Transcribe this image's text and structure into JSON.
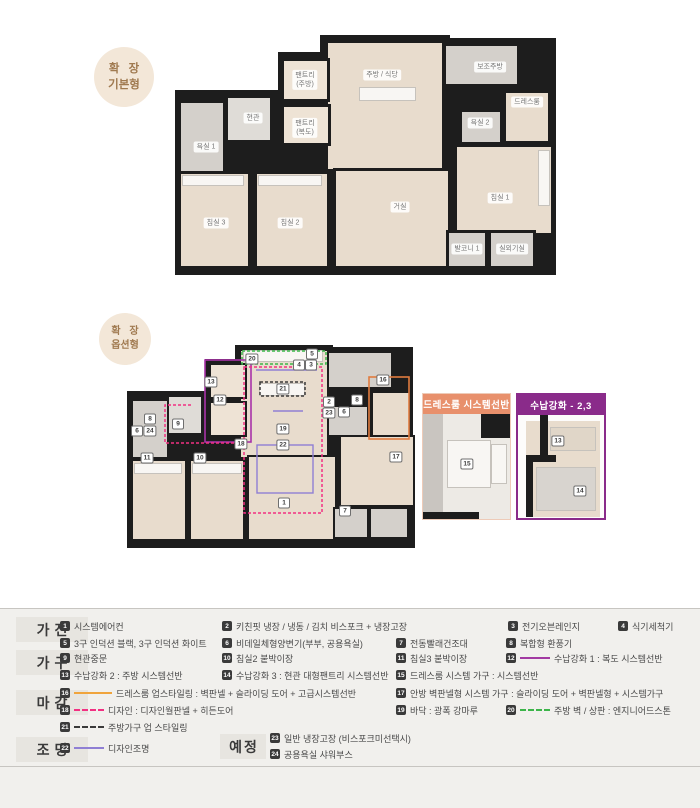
{
  "colors": {
    "badge_bg": "#f3e7d8",
    "badge_text": "#a07a50",
    "wall": "#1d1d1d",
    "floor_wood": "#e8dccd",
    "floor_tile": "#d4d0cb",
    "pink_dashed": "#f23082",
    "green_dashed": "#3cb54a",
    "dark_dashed": "#3a3a3a",
    "orange_outline": "#e07b3f",
    "orange_line": "#f0a43c",
    "purple_outline": "#a832a8",
    "violet_line": "#8f7fd4",
    "dressroom_box_header": "#e8906c",
    "storage_box_header": "#8a2b8a",
    "legend_bg": "#f1f0ed"
  },
  "plans": {
    "basic": {
      "badge": {
        "line1": "확 장",
        "line2": "기본형"
      },
      "rooms": [
        "욕실 1",
        "현관",
        "팬트리\n(주방)",
        "팬트리\n(복도)",
        "주방 / 식당",
        "보조주방",
        "욕실 2",
        "드레스룸",
        "침실 3",
        "침실 2",
        "거실",
        "침실 1",
        "발코니 1",
        "실외기실"
      ]
    },
    "option": {
      "badge": {
        "line1": "확 장",
        "line2": "옵션형"
      },
      "markers": {
        "n1": "1",
        "n2": "2",
        "n3": "3",
        "n4": "4",
        "n5": "5",
        "n6": "6",
        "n7": "7",
        "n8": "8",
        "n9": "9",
        "n10": "10",
        "n11": "11",
        "n12": "12",
        "n13": "13",
        "n16": "16",
        "n17": "17",
        "n18": "18",
        "n19": "19",
        "n20": "20",
        "n21": "21",
        "n22": "22",
        "n23": "23",
        "n24": "24"
      }
    }
  },
  "detail_boxes": [
    {
      "title": "드레스룸 시스템선반",
      "markers": [
        "15"
      ]
    },
    {
      "title": "수납강화 - 2,3",
      "markers": [
        "13",
        "14"
      ]
    }
  ],
  "legend": {
    "categories": [
      {
        "label": "가전",
        "items": [
          {
            "num": "1",
            "text": "시스템에어컨"
          },
          {
            "num": "2",
            "text": "키친핏 냉장 / 냉동 / 김치 비스포크 + 냉장고장"
          },
          {
            "num": "3",
            "text": "전기오븐레인지"
          },
          {
            "num": "4",
            "text": "식기세척기"
          },
          {
            "num": "5",
            "text": "3구 인덕션 블랙, 3구 인덕션 화이트"
          },
          {
            "num": "6",
            "text": "비데일체형양변기(부부, 공용욕실)"
          },
          {
            "num": "7",
            "text": "전동빨래건조대"
          },
          {
            "num": "8",
            "text": "복합형 환풍기"
          }
        ]
      },
      {
        "label": "가구",
        "items": [
          {
            "num": "9",
            "text": "현관중문"
          },
          {
            "num": "10",
            "text": "침실2 붙박이장"
          },
          {
            "num": "11",
            "text": "침실3 붙박이장"
          },
          {
            "num": "12",
            "text": "수납강화 1 : 복도 시스템선반"
          },
          {
            "num": "13",
            "text": "수납강화 2 : 주방 시스템선반"
          },
          {
            "num": "14",
            "text": "수납강화 3 : 현관 대형팬트리 시스템선반"
          },
          {
            "num": "15",
            "text": "드레스룸 시스템 가구 : 시스템선반"
          }
        ]
      },
      {
        "label": "마감",
        "items": [
          {
            "num": "16",
            "text": "드레스룸 업스타일링 : 벽판넬 + 슬라이딩 도어 + 고급시스템선반"
          },
          {
            "num": "17",
            "text": "안방 벽판넬형 시스템 가구 : 슬라이딩 도어 + 벽판넬형 + 시스템가구"
          },
          {
            "num": "18",
            "text": "디자인 : 디자인월판넬 + 히든도어"
          },
          {
            "num": "19",
            "text": "바닥 : 광폭 강마루"
          },
          {
            "num": "20",
            "text": "주방 벽 / 상판 : 엔지니어드스톤"
          },
          {
            "num": "21",
            "text": "주방가구 업 스타일링"
          }
        ]
      },
      {
        "label": "조명",
        "items": [
          {
            "num": "22",
            "text": "디자인조명"
          }
        ]
      },
      {
        "label": "예정",
        "items": [
          {
            "num": "23",
            "text": "일반 냉장고장 (비스포크미선택시)"
          },
          {
            "num": "24",
            "text": "공용욕실 샤워부스"
          }
        ]
      }
    ]
  }
}
